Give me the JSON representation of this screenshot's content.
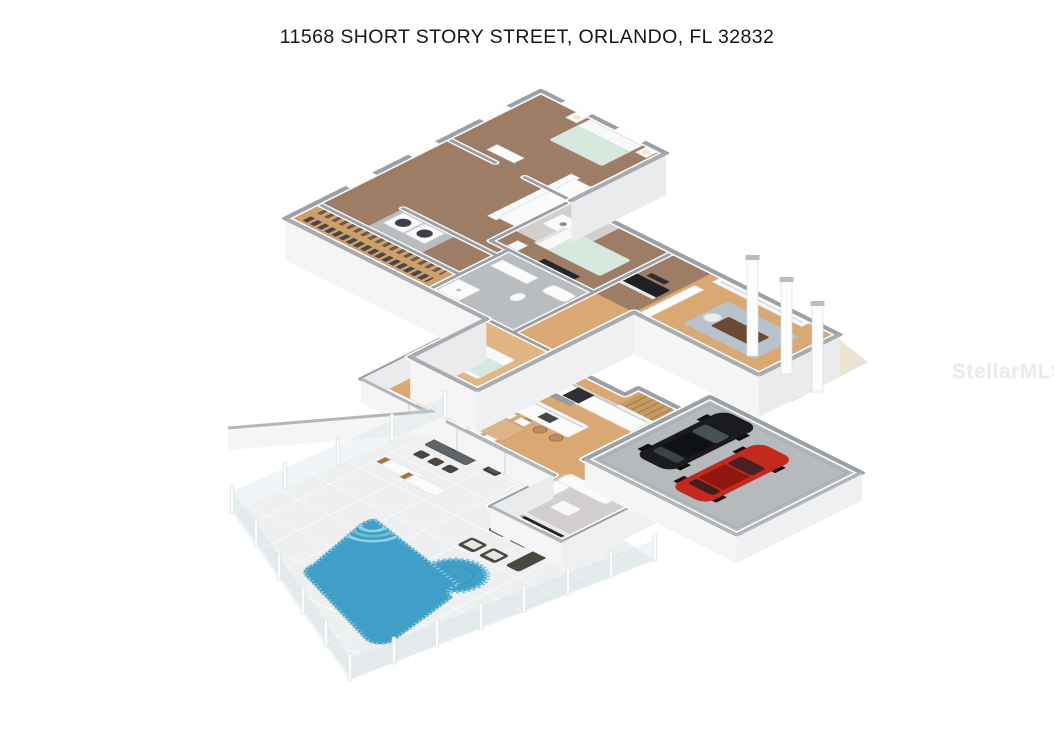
{
  "page": {
    "title": "11568 SHORT STORY STREET, ORLANDO, FL 32832"
  },
  "watermark": {
    "text": "StellarMLS"
  },
  "floor_plan": {
    "type": "3d-isometric-dollhouse-render",
    "features": [
      "two-story house cutaway floor plan",
      "upper level with carpeted bedrooms, walk-in closet, laundry and bathrooms",
      "living room with white sofa and rug",
      "lower level kitchen with island and bar stools",
      "indoor dining table with white chairs",
      "wood staircase to loft office with desk",
      "entry porch with tall white columns",
      "garage with black car and red car",
      "covered lanai with outdoor dining set and grill",
      "wicker lounge furniture",
      "two sun loungers",
      "freeform swimming pool with circular spa and steps",
      "tiled pool deck with glass fence"
    ],
    "colors": {
      "carpet": "#9d7d66",
      "wood_floor": "#d9a873",
      "wood_light": "#e2b582",
      "closet_wood": "#cf9f6b",
      "gray_floor": "#b9bdc0",
      "garage_floor": "#b7babd",
      "deck": "#edeff0",
      "porch": "#ece4d2",
      "pool_water": "#3f9fc6",
      "pool_tile": "#7cc5dd",
      "wall_cap": "#9aa0a5",
      "rug": "#d2cfce",
      "rug_blue": "#b8c2ca",
      "stair_wood": "#c79a63",
      "car_black": "#1a1b1e",
      "car_red": "#c32a1d",
      "dark_furniture": "#47474b",
      "table_wood": "#dcb487",
      "outdoor_dark": "#5f6468",
      "wicker": "#4a4741",
      "blanket": "#d6e9df"
    }
  }
}
